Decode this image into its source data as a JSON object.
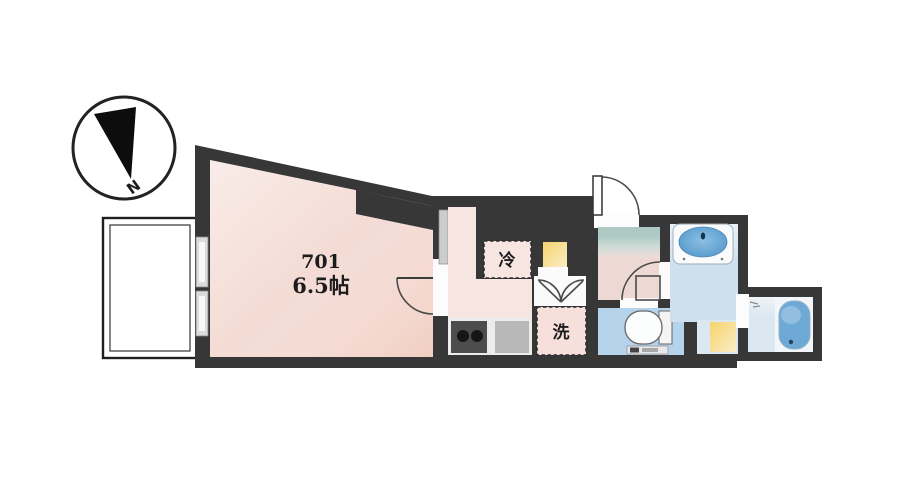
{
  "compass": {
    "north_label": "N"
  },
  "unit": {
    "room_number": "701",
    "room_size": "6.5帖",
    "fridge_label": "冷",
    "washer_label": "洗"
  },
  "colors": {
    "wall": "#373737",
    "room_floor": "#f4dcd5",
    "kitchen_floor": "#f7e5e1",
    "hall_floor": "#eed8d4",
    "entrance_accent": "#aec9c3",
    "wet_floor": "#cfdfed",
    "toilet_floor": "#b6d3ec",
    "bath_floor": "#dbe7f1",
    "tub_blue": "#6ea9d6",
    "basin_blue": "#5d9fd1",
    "accent_yellow": "#f5d36e",
    "counter_gray": "#ececec",
    "stove_dark": "#4d4d4d",
    "sink_gray": "#b8b8b8",
    "balcony_white": "#ffffff"
  }
}
